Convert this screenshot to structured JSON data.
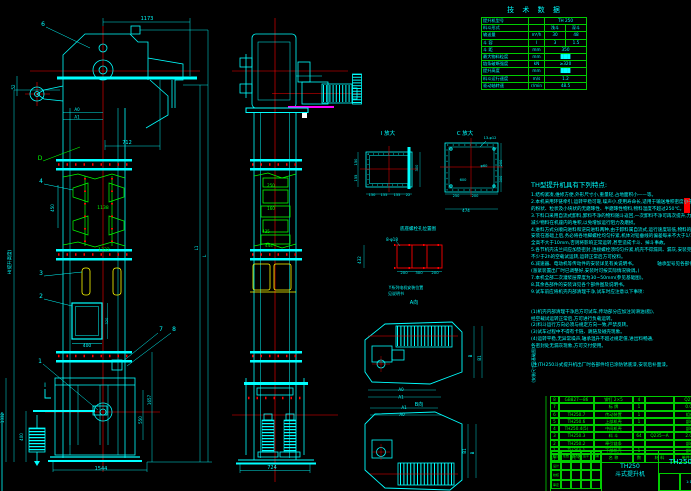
{
  "colors": {
    "cyan": "#00ffff",
    "green": "#00ff00",
    "red": "#ff0000",
    "yellow": "#ffff00",
    "white": "#ffffff",
    "magenta": "#ff00ff",
    "bg": "#000000"
  },
  "tech_table": {
    "title": "技 术 数 据",
    "rows": [
      {
        "label": "提升机型号",
        "unit": "",
        "v1": "TH 250"
      },
      {
        "label": "料斗形式",
        "unit": "",
        "v1": "浅斗",
        "v2": "深斗"
      },
      {
        "label": "输送量",
        "unit": "m³/h",
        "v1": "30",
        "v2": "48"
      },
      {
        "label": "斗  容",
        "unit": "l",
        "v1": "3",
        "v2": "1.5"
      },
      {
        "label": "斗  距",
        "unit": "mm",
        "v1": "350"
      },
      {
        "label": "最大物料粒度",
        "unit": "mm",
        "v1": "███"
      },
      {
        "label": "链条破断强度",
        "unit": "kN",
        "v1": "≥320"
      },
      {
        "label": "提升高度",
        "unit": "mm",
        "v1": "███"
      },
      {
        "label": "料斗运行速度",
        "unit": "m/s",
        "v1": "1.2"
      },
      {
        "label": "驱动轴转速",
        "unit": "r/min",
        "v1": "48.5"
      }
    ]
  },
  "notes": {
    "title": "TH型提升机具有下列特点:",
    "lines": [
      "1.结构紧凑,维修方便,外形尺寸小,重量轻,占地面积小——等。",
      "2.本机采用环链牵引,运转平稳可靠,噪声小,使用寿命长,适用于输送堆积密度小于1.5t/m³",
      "  的粉状、粒状及小块状的无磨琢性、半磨琢性物料,物料温度不超过250℃。",
      "3.下料口采用自流式卸料,卸料不净的物料随斗返回,一次卸料不净可再次提升,力求",
      "  减少物料在机座内的堆积,以免增加运行阻力及磨损。",
      "4.进料方式分顺向进料和逆向进料两种,由于卸料属自流式,运行速度较低,物料的破碎率小。",
      "  安装在基础上后,务必将各地脚螺栓均匀拧紧,机体对铅垂线的偏差每米不大于1/1000,",
      "  全高不大于10mm,否则将影响正常运转,甚至造成卡斗、掉斗事故。",
      "5.各节机壳法兰间应加垫密封,连接螺栓须均匀拧紧,机壳不得漏风、漏灰,安装完毕后应进行",
      "  不少于2h的空载试运转,运转正常后方可投料。",
      "6.减速器、电动机等传动件的安装详见有关说明书。　　　　　轴承型号见各部件图。",
      "  (涨紧装置出厂时已调整好,安装时可按实际情况微调。)",
      "7.本机全部二次灌浆层厚度为30~50mm(参见基础图)。",
      "8.其余各部件的安装详见各个部件图及说明书。",
      "9.试车前应将机壳内部清理干净,试车时应注意以下事项:"
    ],
    "subnotes": [
      "(1)机壳内部清理干净后方可试车,传动部分应加注润滑油(脂),",
      "   经空载试运转正常后,方可进行负载运转。",
      "(2)料斗运行方向必须与规定方向一致,严禁反转。",
      "(3)试车过程中不得有卡链、跳链及碰壳现象。",
      "(4)运转平稳,无异常噪声,轴承温升不超过规定值,进出料畅通,",
      "   各密封处无漏灰现象,方可交付使用。"
    ],
    "footnote": "(注)TH250斗式提升机出厂时各部件均已涂防锈底漆,安装后补面漆。"
  },
  "parts_table": {
    "headers": [
      "序",
      "代  号",
      "名  称",
      "数",
      "材  料",
      "单件重量"
    ],
    "rows": [
      [
        "8",
        "GB827—86",
        "铆钉 2×5",
        "4",
        "",
        "Q215"
      ],
      [
        "7",
        "",
        "标  牌",
        "1",
        "",
        "0.03"
      ],
      [
        "6",
        "TH250.7",
        "传动装置",
        "1",
        "",
        "组件"
      ],
      [
        "5",
        "TH250.6",
        "上部机壳",
        "1",
        "",
        "部件"
      ],
      [
        "4",
        "TH250.4(5)",
        "中间机壳",
        "",
        "",
        "部件"
      ],
      [
        "3",
        "TH250.3",
        "料  斗",
        "64",
        "Q235—A",
        "2.06"
      ],
      [
        "2",
        "TH250.2",
        "牵引链条",
        "",
        "",
        "部件"
      ],
      [
        "1",
        "TH250.1",
        "下部机壳",
        "1",
        "",
        "部件"
      ]
    ]
  },
  "title_block": {
    "model": "TH250",
    "name": "斗式提升机",
    "drawing_no": "TH250",
    "left_cells": [
      "标记",
      "处数",
      "更改文件号",
      "签字",
      "日期",
      "设计",
      "",
      "",
      "",
      "",
      "校核",
      "",
      "",
      "",
      "",
      "审定",
      "",
      "",
      "",
      ""
    ],
    "sub_cells": [
      "",
      "1:10",
      ""
    ]
  },
  "drawing": {
    "labels": [
      {
        "n": "balloon-6",
        "t": "6",
        "x": 43,
        "y": 26,
        "c": "cyan",
        "s": 6
      },
      {
        "n": "dim-1173",
        "t": "1173",
        "x": 147,
        "y": 20,
        "c": "cyan",
        "s": 5
      },
      {
        "n": "dim-a0",
        "t": "A0",
        "x": 77,
        "y": 111,
        "c": "cyan",
        "s": 4
      },
      {
        "n": "dim-a1",
        "t": "A1",
        "x": 77,
        "y": 118.5,
        "c": "cyan",
        "s": 4
      },
      {
        "n": "dim-52",
        "t": "52",
        "x": 15,
        "y": 87,
        "c": "cyan",
        "s": 4,
        "r": -90
      },
      {
        "n": "label-d",
        "t": "D",
        "x": 40,
        "y": 160,
        "c": "green",
        "s": 6
      },
      {
        "n": "balloon-4",
        "t": "4",
        "x": 41,
        "y": 183,
        "c": "cyan",
        "s": 6
      },
      {
        "n": "dim-712",
        "t": "712",
        "x": 127,
        "y": 144,
        "c": "cyan",
        "s": 5
      },
      {
        "n": "dim-450",
        "t": "450",
        "x": 54,
        "y": 208,
        "c": "cyan",
        "s": 4,
        "r": -90
      },
      {
        "n": "dim-1138",
        "t": "1138",
        "x": 103,
        "y": 209,
        "c": "green",
        "s": 4.5
      },
      {
        "n": "dim-1332-mid",
        "t": "1332",
        "x": 104,
        "y": 251,
        "c": "green",
        "s": 4.5
      },
      {
        "n": "balloon-3",
        "t": "3",
        "x": 41,
        "y": 275,
        "c": "cyan",
        "s": 6
      },
      {
        "n": "balloon-2",
        "t": "2",
        "x": 41,
        "y": 298,
        "c": "cyan",
        "s": 6
      },
      {
        "n": "dim-400-door",
        "t": "400",
        "x": 87,
        "y": 347,
        "c": "cyan",
        "s": 4.5
      },
      {
        "n": "dim-320",
        "t": "320",
        "x": 108,
        "y": 321,
        "c": "cyan",
        "s": 3.6,
        "r": -90
      },
      {
        "n": "balloon-7",
        "t": "7",
        "x": 161,
        "y": 331,
        "c": "cyan",
        "s": 6
      },
      {
        "n": "balloon-8",
        "t": "8",
        "x": 174,
        "y": 331,
        "c": "cyan",
        "s": 6
      },
      {
        "n": "balloon-1",
        "t": "1",
        "x": 40,
        "y": 363,
        "c": "cyan",
        "s": 6
      },
      {
        "n": "section-i",
        "t": "I",
        "x": 45,
        "y": 387,
        "c": "cyan",
        "s": 6
      },
      {
        "n": "dim-1657",
        "t": "1657",
        "x": 151,
        "y": 400,
        "c": "cyan",
        "s": 4,
        "r": -90
      },
      {
        "n": "dim-550",
        "t": "550",
        "x": 142,
        "y": 420,
        "c": "cyan",
        "s": 4,
        "r": -90
      },
      {
        "n": "dim-1332-left",
        "t": "1332",
        "x": 4,
        "y": 418,
        "c": "cyan",
        "s": 4,
        "r": -90
      },
      {
        "n": "dim-400-left",
        "t": "400",
        "x": 23,
        "y": 437,
        "c": "cyan",
        "s": 4,
        "r": -90
      },
      {
        "n": "dim-1544",
        "t": "1544",
        "x": 101,
        "y": 470,
        "c": "cyan",
        "s": 5
      },
      {
        "n": "dim-h-total",
        "t": "H(提升高度)",
        "x": 11,
        "y": 262,
        "c": "cyan",
        "s": 4.5,
        "r": -90
      },
      {
        "n": "dim-l1",
        "t": "L1",
        "x": 198,
        "y": 248,
        "c": "cyan",
        "s": 4,
        "r": -90
      },
      {
        "n": "dim-l",
        "t": "L",
        "x": 206,
        "y": 256,
        "c": "cyan",
        "s": 4.5,
        "r": -90
      },
      {
        "n": "dim-250-side",
        "t": "250",
        "x": 271,
        "y": 187,
        "c": "green",
        "s": 4
      },
      {
        "n": "dim-160-side",
        "t": "160",
        "x": 271,
        "y": 210,
        "c": "green",
        "s": 4
      },
      {
        "n": "dim-435-side",
        "t": "435",
        "x": 266,
        "y": 233,
        "c": "green",
        "s": 4
      },
      {
        "n": "dim-444-side",
        "t": "444",
        "x": 269,
        "y": 247,
        "c": "green",
        "s": 4
      },
      {
        "n": "dim-724",
        "t": "724",
        "x": 272,
        "y": 469,
        "c": "cyan",
        "s": 5
      },
      {
        "n": "detail-i-title",
        "t": "I 放大",
        "x": 388,
        "y": 135,
        "c": "cyan",
        "s": 5.5
      },
      {
        "n": "dim-i-150",
        "t": "150",
        "x": 372,
        "y": 196,
        "c": "cyan",
        "s": 3.6
      },
      {
        "n": "dim-i-155a",
        "t": "155",
        "x": 384,
        "y": 196,
        "c": "cyan",
        "s": 3.6
      },
      {
        "n": "dim-i-155b",
        "t": "155",
        "x": 397,
        "y": 196,
        "c": "cyan",
        "s": 3.6
      },
      {
        "n": "dim-i-22",
        "t": "22",
        "x": 408,
        "y": 196,
        "c": "cyan",
        "s": 3.6
      },
      {
        "n": "dim-i-150l",
        "t": "150",
        "x": 357,
        "y": 162,
        "c": "cyan",
        "s": 3.6,
        "r": -90
      },
      {
        "n": "dim-i-155l",
        "t": "155",
        "x": 357,
        "y": 178,
        "c": "cyan",
        "s": 3.6,
        "r": -90
      },
      {
        "n": "dim-i-300",
        "t": "300",
        "x": 418,
        "y": 168,
        "c": "cyan",
        "s": 3.6,
        "r": -90
      },
      {
        "n": "view-c-title",
        "t": "C 放大",
        "x": 465,
        "y": 135,
        "c": "cyan",
        "s": 5.5
      },
      {
        "n": "note-13holes",
        "t": "13-φ12",
        "x": 490,
        "y": 139,
        "c": "cyan",
        "s": 3.6
      },
      {
        "n": "dim-c-250",
        "t": "250",
        "x": 456,
        "y": 197,
        "c": "cyan",
        "s": 3.6
      },
      {
        "n": "dim-c-200",
        "t": "200",
        "x": 475,
        "y": 197,
        "c": "cyan",
        "s": 3.6
      },
      {
        "n": "dim-c-474",
        "t": "474",
        "x": 466,
        "y": 212,
        "c": "cyan",
        "s": 4
      },
      {
        "n": "dim-c-200r",
        "t": "200",
        "x": 502,
        "y": 163,
        "c": "cyan",
        "s": 3.6,
        "r": -90
      },
      {
        "n": "dim-c-300r",
        "t": "300",
        "x": 502,
        "y": 179,
        "c": "cyan",
        "s": 3.6,
        "r": -90
      },
      {
        "n": "dim-c-600",
        "t": "600",
        "x": 463,
        "y": 181,
        "c": "cyan",
        "s": 3.6
      },
      {
        "n": "dim-c-phi",
        "t": "φ60",
        "x": 484,
        "y": 167,
        "c": "cyan",
        "s": 3.6
      },
      {
        "n": "anchor-grid-title",
        "t": "底座螺栓孔位置图",
        "x": 418,
        "y": 230,
        "c": "cyan",
        "s": 4.5
      },
      {
        "n": "note-8holes",
        "t": "8-φ18",
        "x": 392,
        "y": 241,
        "c": "cyan",
        "s": 4
      },
      {
        "n": "dim-g-432",
        "t": "432",
        "x": 361,
        "y": 260,
        "c": "cyan",
        "s": 4,
        "r": -90
      },
      {
        "n": "dim-g-200a",
        "t": "200",
        "x": 404,
        "y": 274,
        "c": "cyan",
        "s": 3.8
      },
      {
        "n": "dim-g-300",
        "t": "300",
        "x": 419,
        "y": 274,
        "c": "cyan",
        "s": 3.8
      },
      {
        "n": "dim-g-200b",
        "t": "200",
        "x": 435,
        "y": 274,
        "c": "cyan",
        "s": 3.8
      },
      {
        "n": "motor-note-1",
        "t": "Y系列电机安装位置",
        "x": 406,
        "y": 289,
        "c": "cyan",
        "s": 4
      },
      {
        "n": "motor-note-2",
        "t": "见说明书",
        "x": 396,
        "y": 295,
        "c": "cyan",
        "s": 4
      },
      {
        "n": "view-a-label",
        "t": "A向",
        "x": 414,
        "y": 304,
        "c": "cyan",
        "s": 5
      },
      {
        "n": "dim-p1-a0",
        "t": "A0",
        "x": 401,
        "y": 391,
        "c": "cyan",
        "s": 4
      },
      {
        "n": "dim-p1-a1",
        "t": "A1",
        "x": 401,
        "y": 398.5,
        "c": "cyan",
        "s": 4
      },
      {
        "n": "dim-p1-b",
        "t": "B",
        "x": 472,
        "y": 356,
        "c": "cyan",
        "s": 4,
        "r": -90
      },
      {
        "n": "dim-p1-b1",
        "t": "B1",
        "x": 481,
        "y": 358,
        "c": "cyan",
        "s": 4,
        "r": -90
      },
      {
        "n": "view-b-label",
        "t": "B向",
        "x": 419,
        "y": 406,
        "c": "cyan",
        "s": 5
      },
      {
        "n": "dim-p2-a1",
        "t": "A1",
        "x": 404,
        "y": 409,
        "c": "cyan",
        "s": 4
      },
      {
        "n": "dim-p2-a0",
        "t": "A0",
        "x": 402,
        "y": 416,
        "c": "cyan",
        "s": 4
      },
      {
        "n": "dim-p2-b1",
        "t": "B1",
        "x": 466,
        "y": 451,
        "c": "cyan",
        "s": 4,
        "r": -90
      },
      {
        "n": "dim-p2-b",
        "t": "B",
        "x": 474,
        "y": 453,
        "c": "cyan",
        "s": 4,
        "r": -90
      },
      {
        "n": "side-note-vertical",
        "t": "(安装尺寸见基础图)",
        "x": 535,
        "y": 365,
        "c": "cyan",
        "s": 4,
        "r": -90
      }
    ]
  }
}
